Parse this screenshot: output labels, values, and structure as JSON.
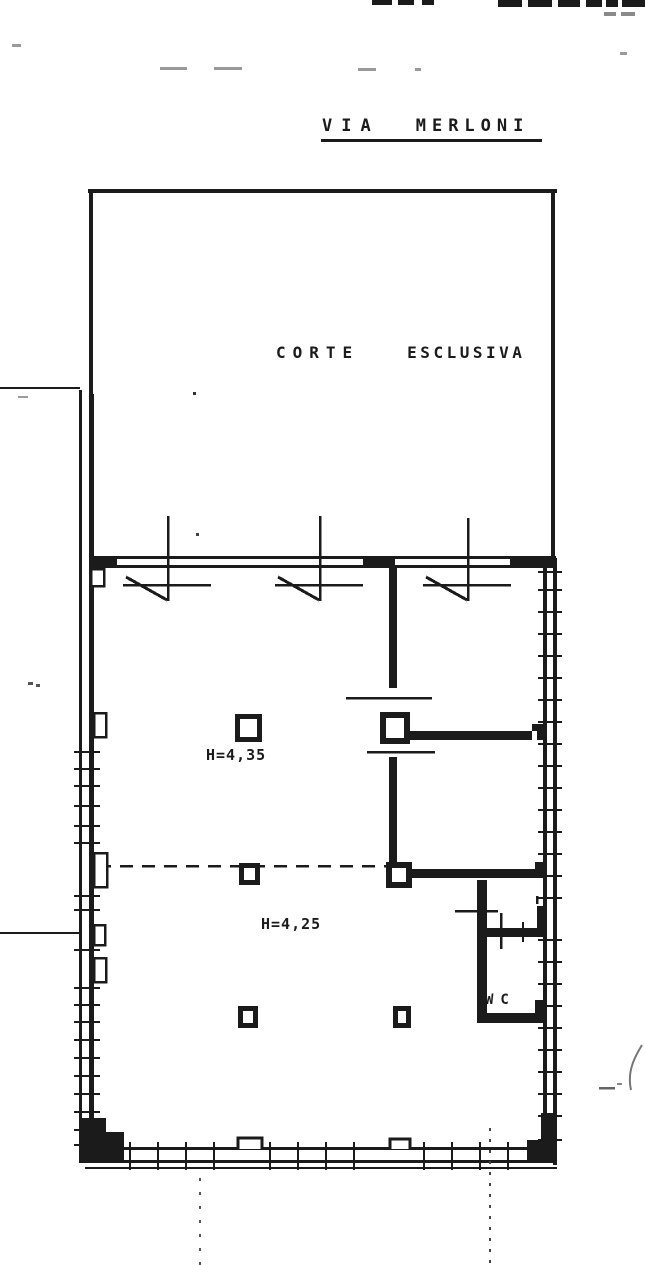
{
  "colors": {
    "ink": "#1b1b1b",
    "paper": "#ffffff",
    "faint": "#8a8a8a"
  },
  "labels": {
    "street": {
      "word1": "VIA",
      "word2": "MERLONI"
    },
    "courtyard": {
      "word1": "CORTE",
      "word2": "ESCLUSIVA"
    },
    "room_upper_height": "H=4,35",
    "room_lower_height": "H=4,25",
    "wc": "WC"
  }
}
